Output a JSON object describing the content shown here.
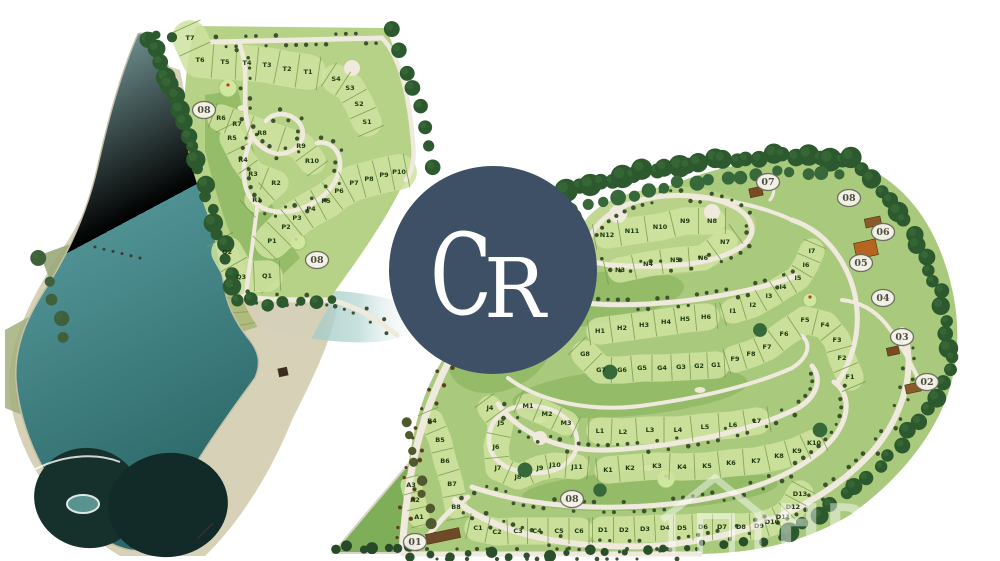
{
  "map": {
    "type": "residential-golf-estate-master-plan",
    "logo": {
      "text": "CR",
      "bg_color": "#3d5065",
      "text_color": "#ffffff"
    },
    "watermark": {
      "icon": "house-icon",
      "text_fragments": [
        "HD",
        "hv"
      ],
      "color": "#ffffff",
      "opacity": 0.45
    },
    "colors": {
      "lake_light": "#8fbdbd",
      "lake_mid": "#4f9193",
      "lake_deep": "#2c6868",
      "lake_dark_blob": "#16302c",
      "sand": "#d7d1b8",
      "marsh": "#9aa877",
      "land_left": "#b5d287",
      "land_right": "#a9c97c",
      "parcel_band": "#cfe3a0",
      "fairway": "#8fb863",
      "road": "#efeadd",
      "tree": "#2c5a2e",
      "lot_line": "#7d9b50",
      "label_text": "#203a12",
      "badge_fill": "#f5f3ea",
      "badge_stroke": "#6a6a5e",
      "badge_text": "#4c4c40"
    },
    "badges": [
      {
        "label": "01",
        "x": 415,
        "y": 542
      },
      {
        "label": "02",
        "x": 927,
        "y": 382
      },
      {
        "label": "03",
        "x": 902,
        "y": 337
      },
      {
        "label": "04",
        "x": 883,
        "y": 298
      },
      {
        "label": "05",
        "x": 861,
        "y": 263
      },
      {
        "label": "06",
        "x": 883,
        "y": 232
      },
      {
        "label": "07",
        "x": 768,
        "y": 182
      },
      {
        "label": "08",
        "x": 849,
        "y": 198
      },
      {
        "label": "08",
        "x": 204,
        "y": 110
      },
      {
        "label": "08",
        "x": 317,
        "y": 260
      },
      {
        "label": "08",
        "x": 572,
        "y": 499
      }
    ],
    "lot_series": [
      {
        "name": "T",
        "tick": 34,
        "labels": [
          [
            "T7",
            190,
            38
          ],
          [
            "T6",
            200,
            60
          ],
          [
            "T5",
            225,
            62
          ],
          [
            "T4",
            247,
            63
          ],
          [
            "T3",
            267,
            65
          ],
          [
            "T2",
            287,
            69
          ],
          [
            "T1",
            308,
            72
          ]
        ]
      },
      {
        "name": "S",
        "tick": 28,
        "labels": [
          [
            "S4",
            336,
            79
          ],
          [
            "S3",
            350,
            88
          ],
          [
            "S2",
            359,
            104
          ],
          [
            "S1",
            367,
            122
          ]
        ]
      },
      {
        "name": "R-outer",
        "tick": 26,
        "labels": [
          [
            "R6",
            221,
            118
          ],
          [
            "R7",
            237,
            124
          ],
          [
            "R8",
            262,
            133
          ],
          [
            "R9",
            301,
            146
          ],
          [
            "R10",
            312,
            161
          ]
        ]
      },
      {
        "name": "R-inner",
        "tick": 24,
        "labels": [
          [
            "R5",
            232,
            138
          ],
          [
            "R4",
            243,
            160
          ],
          [
            "R3",
            253,
            174
          ],
          [
            "R2",
            276,
            183
          ],
          [
            "R1",
            257,
            200
          ]
        ]
      },
      {
        "name": "P",
        "tick": 34,
        "labels": [
          [
            "P1",
            272,
            241
          ],
          [
            "P2",
            286,
            227
          ],
          [
            "P3",
            297,
            218
          ],
          [
            "P4",
            311,
            209
          ],
          [
            "P5",
            326,
            201
          ],
          [
            "P6",
            339,
            191
          ],
          [
            "P7",
            354,
            183
          ],
          [
            "P8",
            369,
            179
          ],
          [
            "P9",
            384,
            175
          ],
          [
            "P10",
            399,
            172
          ]
        ]
      },
      {
        "name": "Q",
        "tick": 30,
        "labels": [
          [
            "Q2",
            227,
            252
          ],
          [
            "Q3",
            241,
            277
          ],
          [
            "Q1",
            267,
            276
          ]
        ]
      },
      {
        "name": "N-outer",
        "tick": 26,
        "labels": [
          [
            "N12",
            607,
            235
          ],
          [
            "N11",
            632,
            231
          ],
          [
            "N10",
            660,
            227
          ],
          [
            "N9",
            685,
            221
          ],
          [
            "N8",
            712,
            221
          ]
        ]
      },
      {
        "name": "N-inner",
        "tick": 24,
        "labels": [
          [
            "N3",
            620,
            270
          ],
          [
            "N4",
            648,
            264
          ],
          [
            "N5",
            675,
            260
          ],
          [
            "N6",
            703,
            258
          ],
          [
            "N7",
            725,
            242
          ]
        ]
      },
      {
        "name": "H",
        "tick": 26,
        "labels": [
          [
            "H1",
            600,
            331
          ],
          [
            "H2",
            622,
            328
          ],
          [
            "H3",
            644,
            325
          ],
          [
            "H4",
            666,
            322
          ],
          [
            "H5",
            685,
            319
          ],
          [
            "H6",
            706,
            317
          ]
        ]
      },
      {
        "name": "I",
        "tick": 24,
        "labels": [
          [
            "I1",
            733,
            311
          ],
          [
            "I2",
            753,
            305
          ],
          [
            "I3",
            769,
            296
          ],
          [
            "I4",
            783,
            287
          ],
          [
            "I5",
            798,
            278
          ],
          [
            "I6",
            806,
            265
          ],
          [
            "I7",
            812,
            251
          ]
        ]
      },
      {
        "name": "G",
        "tick": 26,
        "labels": [
          [
            "G8",
            585,
            354
          ],
          [
            "G7",
            601,
            370
          ],
          [
            "G6",
            622,
            370
          ],
          [
            "G5",
            642,
            368
          ],
          [
            "G4",
            662,
            368
          ],
          [
            "G3",
            681,
            367
          ],
          [
            "G2",
            699,
            366
          ],
          [
            "G1",
            716,
            365
          ]
        ]
      },
      {
        "name": "F",
        "tick": 26,
        "labels": [
          [
            "F9",
            735,
            359
          ],
          [
            "F8",
            751,
            354
          ],
          [
            "F7",
            767,
            347
          ],
          [
            "F6",
            784,
            334
          ],
          [
            "F5",
            805,
            320
          ],
          [
            "F4",
            825,
            325
          ],
          [
            "F3",
            837,
            340
          ],
          [
            "F2",
            842,
            358
          ],
          [
            "F1",
            850,
            377
          ]
        ]
      },
      {
        "name": "M",
        "tick": 24,
        "labels": [
          [
            "M1",
            528,
            406
          ],
          [
            "M2",
            547,
            414
          ],
          [
            "M3",
            566,
            423
          ]
        ]
      },
      {
        "name": "L",
        "tick": 26,
        "labels": [
          [
            "L1",
            600,
            431
          ],
          [
            "L2",
            623,
            432
          ],
          [
            "L3",
            650,
            430
          ],
          [
            "L4",
            678,
            430
          ],
          [
            "L5",
            705,
            427
          ],
          [
            "L6",
            733,
            425
          ],
          [
            "L7",
            757,
            421
          ]
        ]
      },
      {
        "name": "K",
        "tick": 26,
        "labels": [
          [
            "K1",
            608,
            470
          ],
          [
            "K2",
            630,
            468
          ],
          [
            "K3",
            657,
            466
          ],
          [
            "K4",
            682,
            467
          ],
          [
            "K5",
            707,
            466
          ],
          [
            "K6",
            731,
            463
          ],
          [
            "K7",
            756,
            461
          ],
          [
            "K8",
            779,
            456
          ],
          [
            "K9",
            797,
            451
          ],
          [
            "K10",
            814,
            443
          ]
        ]
      },
      {
        "name": "J",
        "tick": 24,
        "labels": [
          [
            "J4",
            490,
            408
          ],
          [
            "J5",
            501,
            423
          ],
          [
            "J6",
            496,
            447
          ],
          [
            "J7",
            498,
            468
          ],
          [
            "J8",
            518,
            477
          ],
          [
            "J9",
            540,
            468
          ],
          [
            "J10",
            555,
            465
          ],
          [
            "J11",
            577,
            467
          ]
        ]
      },
      {
        "name": "D",
        "tick": 26,
        "labels": [
          [
            "D1",
            603,
            530
          ],
          [
            "D2",
            624,
            530
          ],
          [
            "D3",
            645,
            529
          ],
          [
            "D4",
            665,
            528
          ],
          [
            "D5",
            682,
            528
          ],
          [
            "D6",
            703,
            527
          ],
          [
            "D7",
            722,
            527
          ],
          [
            "D8",
            741,
            527
          ],
          [
            "D9",
            759,
            526
          ],
          [
            "D10",
            772,
            522
          ],
          [
            "D11",
            783,
            517
          ],
          [
            "D12",
            793,
            507
          ],
          [
            "D13",
            800,
            494
          ]
        ]
      },
      {
        "name": "C",
        "tick": 26,
        "labels": [
          [
            "C1",
            478,
            528
          ],
          [
            "C2",
            497,
            532
          ],
          [
            "C3",
            518,
            531
          ],
          [
            "C4",
            537,
            531
          ],
          [
            "C5",
            559,
            531
          ],
          [
            "C6",
            579,
            531
          ]
        ]
      },
      {
        "name": "B",
        "tick": 22,
        "labels": [
          [
            "B4",
            432,
            421
          ],
          [
            "B5",
            440,
            440
          ],
          [
            "B6",
            445,
            461
          ],
          [
            "B7",
            452,
            484
          ],
          [
            "B8",
            456,
            507
          ]
        ]
      },
      {
        "name": "A",
        "tick": 20,
        "labels": [
          [
            "A3",
            411,
            485
          ],
          [
            "A2",
            415,
            500
          ],
          [
            "A1",
            419,
            517
          ]
        ]
      }
    ],
    "structures": [
      {
        "name": "entrance-gate",
        "x": 443,
        "y": 536,
        "w": 34,
        "h": 10,
        "color": "#6e4a26"
      },
      {
        "name": "clubhouse",
        "x": 866,
        "y": 249,
        "w": 22,
        "h": 16,
        "color": "#b5651d"
      },
      {
        "name": "building",
        "x": 873,
        "y": 222,
        "w": 16,
        "h": 9,
        "color": "#8a5a28"
      },
      {
        "name": "building",
        "x": 756,
        "y": 192,
        "w": 13,
        "h": 9,
        "color": "#7a4a22"
      },
      {
        "name": "building",
        "x": 893,
        "y": 351,
        "w": 12,
        "h": 8,
        "color": "#7a4a22"
      },
      {
        "name": "building",
        "x": 913,
        "y": 388,
        "w": 15,
        "h": 9,
        "color": "#8a5a28"
      },
      {
        "name": "jetty",
        "x": 283,
        "y": 372,
        "w": 9,
        "h": 8,
        "color": "#3a2e1e"
      }
    ]
  }
}
